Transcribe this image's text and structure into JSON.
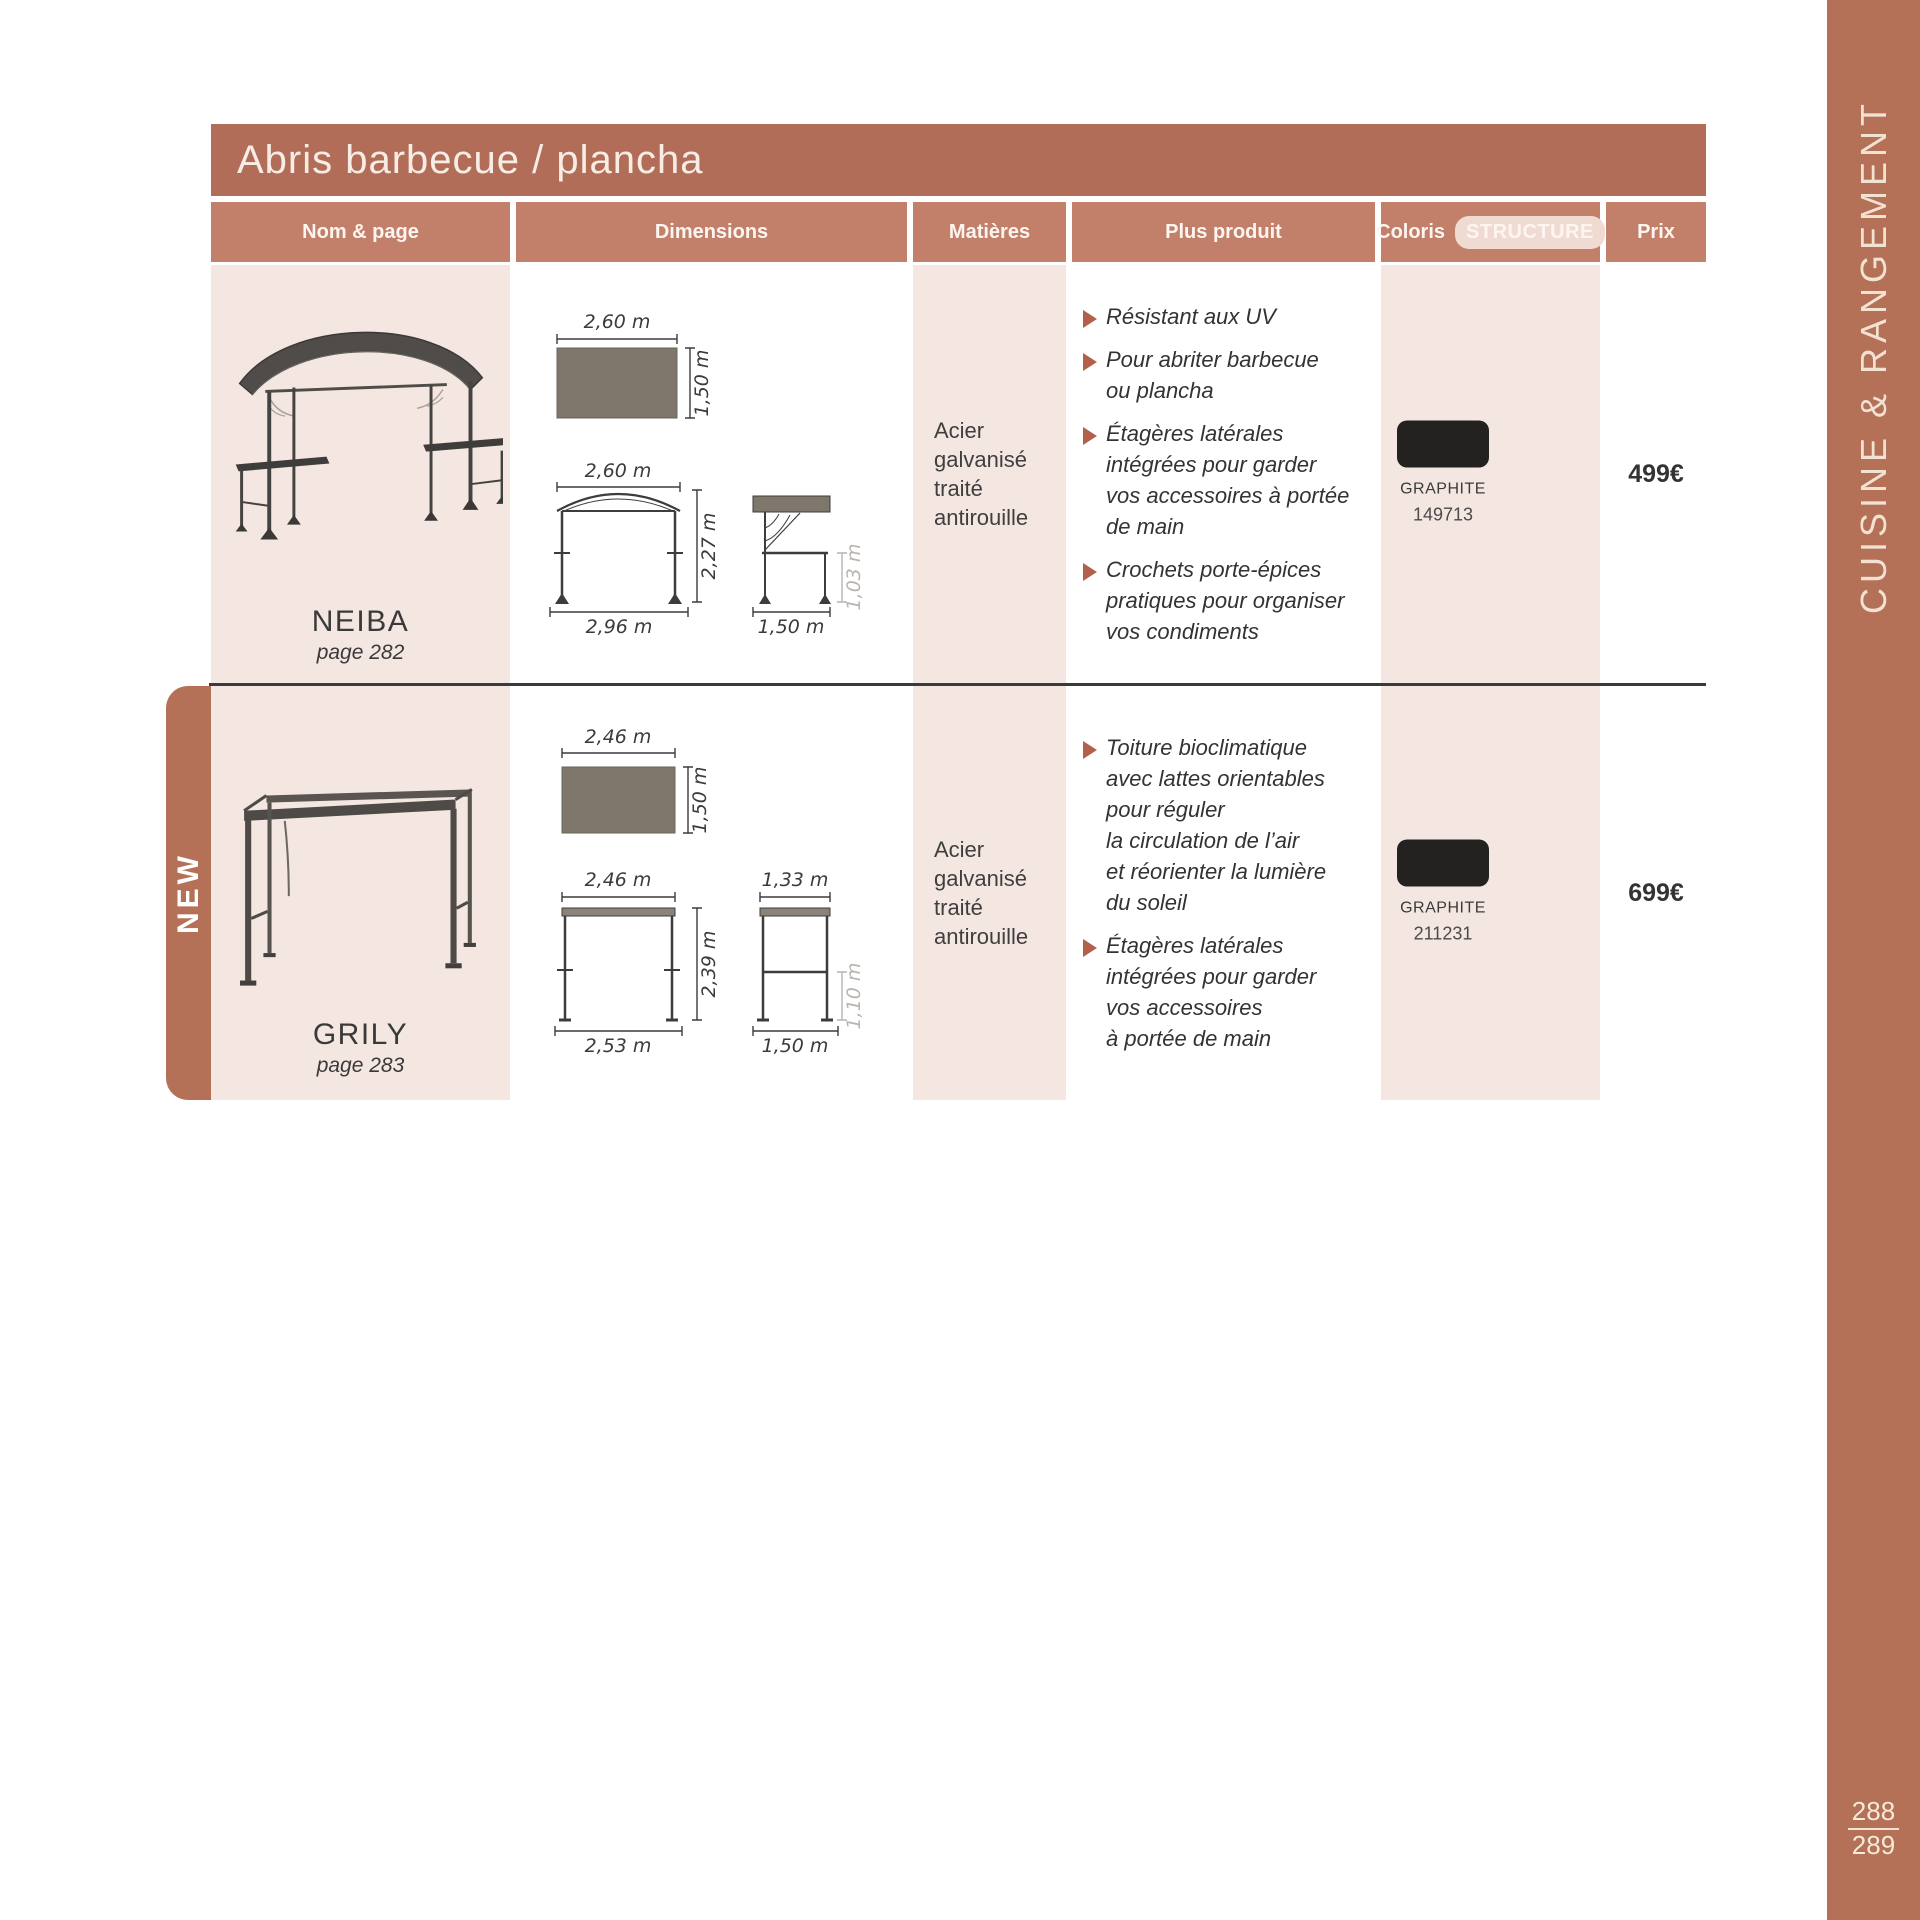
{
  "sidebar": {
    "title": "CUISINE & RANGEMENT",
    "page_top": "288",
    "page_bottom": "289"
  },
  "table": {
    "title": "Abris barbecue / plancha",
    "headers": {
      "nom": "Nom & page",
      "dimensions": "Dimensions",
      "matieres": "Matières",
      "plus": "Plus produit",
      "coloris": "Coloris",
      "structure": "STRUCTURE",
      "prix": "Prix"
    }
  },
  "rows": [
    {
      "name": "NEIBA",
      "page": "page 282",
      "material": "Acier\ngalvanisé\ntraité\nantirouille",
      "dims": {
        "top_width": "2,60 m",
        "top_depth": "1,50 m",
        "front_width": "2,60 m",
        "front_height": "2,27 m",
        "front_base": "2,96 m",
        "side_height": "1,03 m",
        "side_bottom": "1,50 m"
      },
      "features": [
        {
          "text": "Résistant aux UV"
        },
        {
          "text": "Pour abriter barbecue\nou plancha"
        },
        {
          "text": "Étagères latérales\nintégrées pour garder\nvos accessoires à portée\nde main"
        },
        {
          "text": "Crochets porte-épices\npratiques pour organiser\nvos condiments"
        }
      ],
      "coloris": {
        "name": "GRAPHITE",
        "code": "149713",
        "hex": "#242220"
      },
      "price": "499€"
    },
    {
      "name": "GRILY",
      "page": "page 283",
      "badge": "NEW",
      "material": "Acier\ngalvanisé\ntraité\nantirouille",
      "dims": {
        "top_width": "2,46 m",
        "top_depth": "1,50 m",
        "front_width": "2,46 m",
        "front_height": "2,39 m",
        "front_base": "2,53 m",
        "side_top": "1,33 m",
        "side_height": "1,10 m",
        "side_bottom": "1,50 m"
      },
      "features": [
        {
          "text": "Toiture bioclimatique\navec lattes orientables\npour réguler\nla circulation de l’air\net réorienter la lumière\ndu soleil"
        },
        {
          "text": "Étagères latérales\nintégrées pour garder\nvos accessoires\nà portée de main"
        }
      ],
      "coloris": {
        "name": "GRAPHITE",
        "code": "211231",
        "hex": "#242220"
      },
      "price": "699€"
    }
  ],
  "colors": {
    "terracotta_title": "#b26d59",
    "terracotta_header": "#c2806b",
    "sidebar": "#b57058",
    "pink_cell": "#f4e6e0",
    "bullet": "#b2604b",
    "diagram_fill": "#7f776b",
    "swatch": "#242220"
  }
}
